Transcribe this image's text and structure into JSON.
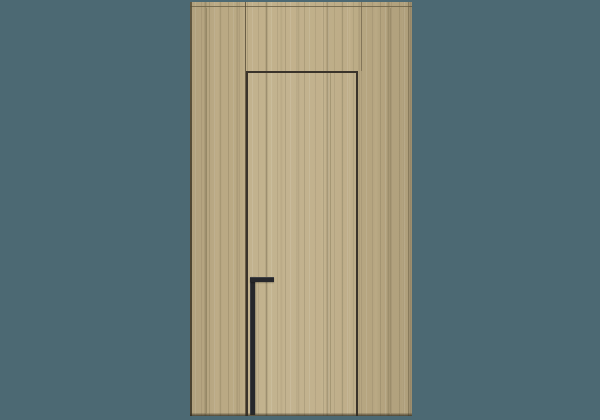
{
  "scene": {
    "description": "Product render of a concealed flush interior door integrated into full-height light oak veneer wall paneling, with a tall black edge-mounted bar handle, centered on a flat teal background",
    "object": "flush concealed door with matching wall panels",
    "material": "light oak wood veneer, vertical grain",
    "handle_style": "tall vertical black bar with short horizontal top return",
    "door_position": "center section of three-part paneled wall, gap outline on top, left and right, leaf runs to floor"
  },
  "colors": {
    "background": "#4c6973",
    "wood_base": "#c0af89",
    "wood_light_streak": "#ccbc96",
    "wood_dark_streak": "#a29472",
    "panel_edge_dark": "#4a422f",
    "seam_line": "#6d6348",
    "door_gap_line": "#3a332a",
    "handle": "#26272b",
    "bottom_shadow": "#302a1d"
  }
}
